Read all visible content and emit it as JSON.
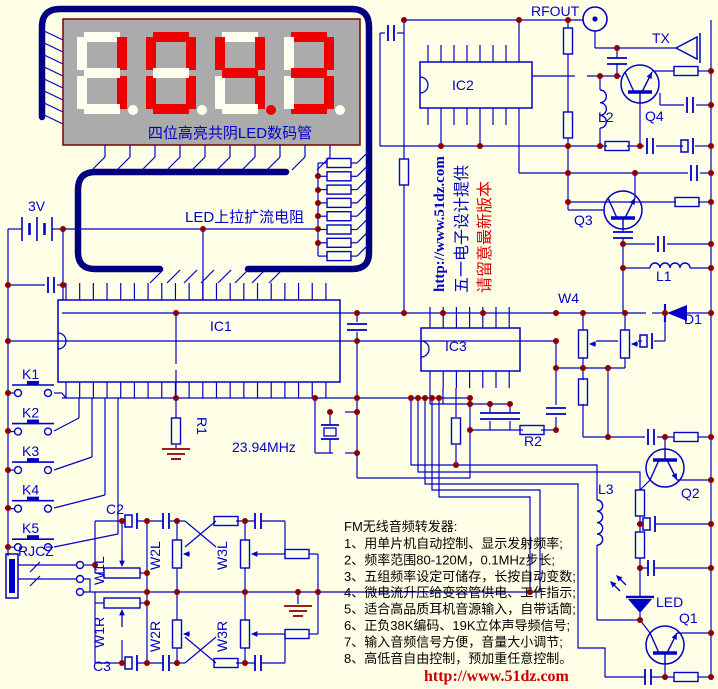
{
  "display": {
    "value": "104.3",
    "digits": [
      "1",
      "0",
      "4",
      "3"
    ],
    "lit_decimal_index": 2,
    "caption": "四位高亮共阴LED数码管"
  },
  "labels": {
    "power": "3V",
    "led_resistor": "LED上拉扩流电阻",
    "ic1": "IC1",
    "ic2": "IC2",
    "ic3": "IC3",
    "r1": "R1",
    "r2": "R2",
    "crystal": "23.94MHz",
    "c2": "C2",
    "c3": "C3",
    "jack": "RJCZ",
    "w4": "W4",
    "rfout": "RFOUT",
    "tx": "TX",
    "q1": "Q1",
    "q2": "Q2",
    "q3": "Q3",
    "q4": "Q4",
    "l1": "L1",
    "l2": "L2",
    "l3": "L3",
    "d1": "D1",
    "led": "LED"
  },
  "switches": [
    "K1",
    "K2",
    "K3",
    "K4",
    "K5"
  ],
  "pots": [
    "W1L",
    "W2L",
    "W3L",
    "W1R",
    "W2R",
    "W3R"
  ],
  "watermark": {
    "url": "http://www.51dz.com",
    "line1": "五一电子设计提供",
    "line2": "请留意最新版本"
  },
  "description": {
    "title": "FM无线音频转发器:",
    "items": [
      "1、用单片机自动控制、显示发射频率;",
      "2、频率范围80-120M，0.1MHz步长;",
      "3、五组频率设定可储存，长按自动变数;",
      "4、微电流升压给变容管供电、工作指示;",
      "5、适合高品质耳机音源输入，自带话筒;",
      "6、正负38K编码、19K立体声导频信号;",
      "7、输入音频信号方便，音量大小调节;",
      "8、高低音自由控制，预加重任意控制。"
    ]
  },
  "footer_url": "http://www.51dz.com",
  "colors": {
    "background": "#FFFFE8",
    "wire": "#0000C8",
    "thick_outline": "#000080",
    "junction": "#8B0000",
    "display_bg": "#ABABAB",
    "segment_lit": "#EE0000",
    "segment_unlit": "#FFFFF0",
    "display_border": "#7A0000",
    "red_text": "#DD0000"
  }
}
